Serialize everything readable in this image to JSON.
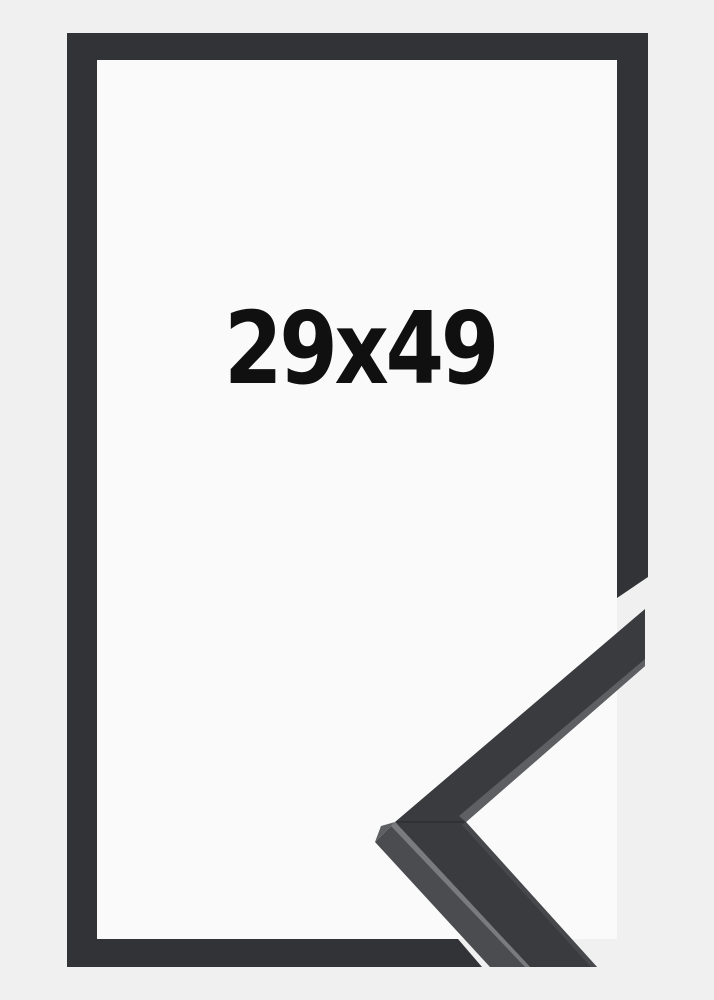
{
  "product": {
    "size_label": "29x49"
  },
  "colors": {
    "background": "#f0f0f1",
    "frame_opening": "#fafafa",
    "frame": "#323336",
    "sample_face": "#3a3b3e",
    "sample_side": "#4b4c4f",
    "sample_bevel": "#5e5f63",
    "sample_inner_highlight": "#47484c",
    "sample_arris": "#7a7b7e",
    "sample_seam": "#232427",
    "text": "#101010"
  }
}
